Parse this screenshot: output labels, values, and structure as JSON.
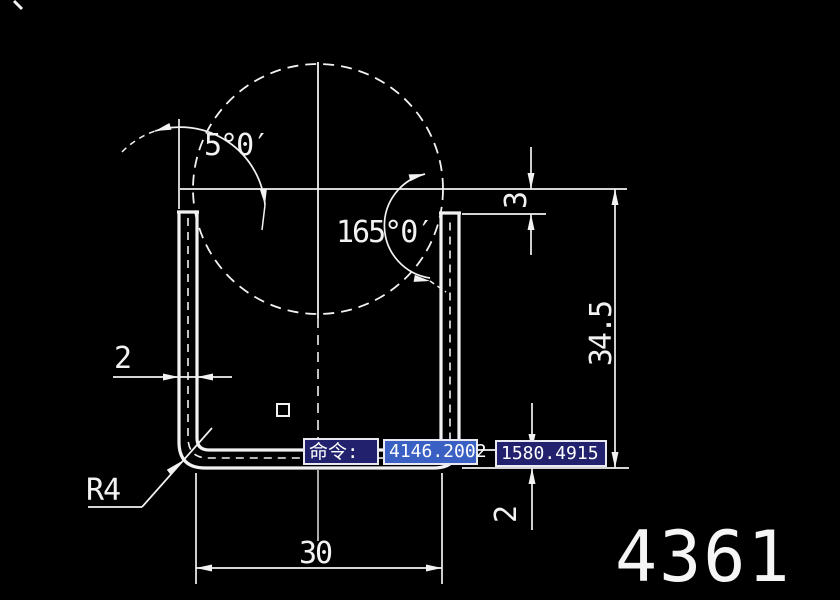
{
  "app": {
    "background": "#000000",
    "line_color": "#f2f2f2"
  },
  "drawing": {
    "labels": {
      "angle_left": "5°0′",
      "angle_right": "165°0′",
      "leg_offset": "3",
      "height": "34.5",
      "wall_thickness": "2",
      "bottom_thickness": "2",
      "inner_width": "30",
      "corner_radius": "R4"
    },
    "sheet_number": "4361"
  },
  "command_bar": {
    "prompt": "命令:",
    "coord_x": "4146.2002",
    "coord_y": "1580.4915",
    "colors": {
      "box_fill": "#21216e",
      "box_fill_selected": "#3a60c4",
      "box_border": "#e9e9f2",
      "text": "#ffffff"
    }
  }
}
